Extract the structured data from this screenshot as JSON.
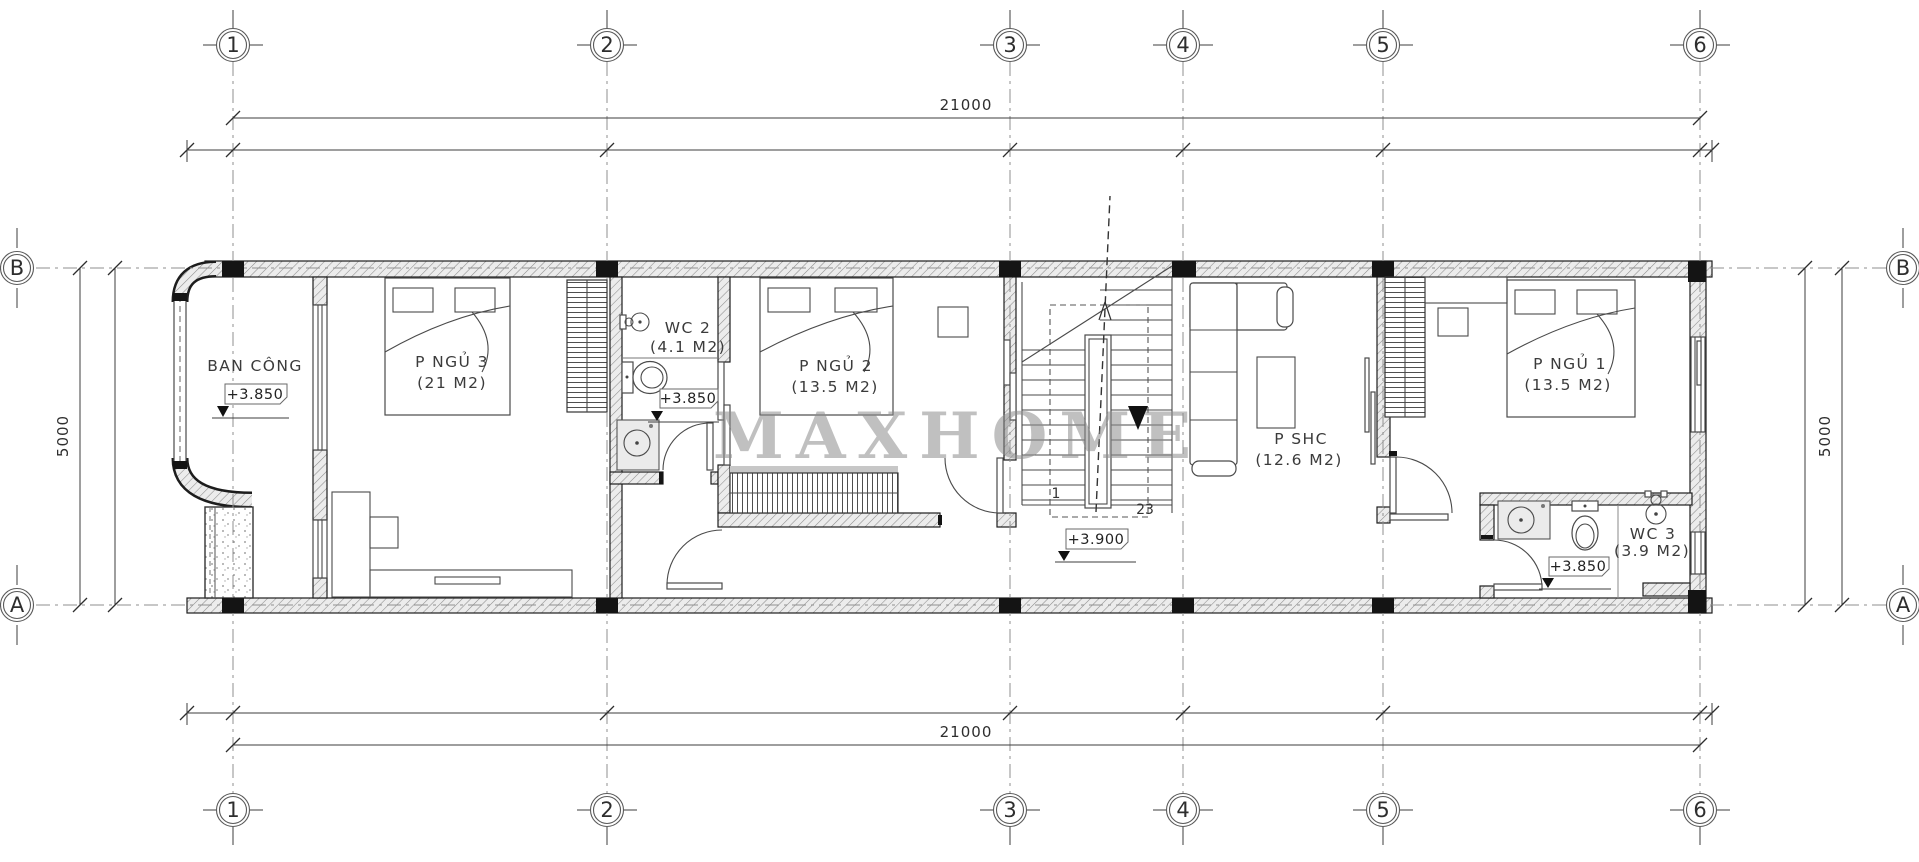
{
  "watermark": "MAXHOME",
  "grid": {
    "columns": [
      "1",
      "2",
      "3",
      "4",
      "5",
      "6"
    ],
    "rows": [
      "B",
      "A"
    ]
  },
  "dims": {
    "top": "21000",
    "bottom": "21000",
    "left": "5000",
    "right": "5000"
  },
  "labels": {
    "balcony": {
      "name": "BAN CÔNG",
      "level": "+3.850"
    },
    "bedroom3": {
      "name": "P NGỦ 3",
      "area": "(21 M2)"
    },
    "wc2": {
      "name": "WC 2",
      "area": "(4.1 M2)",
      "level": "+3.850"
    },
    "bedroom2": {
      "name": "P NGỦ 2",
      "area": "(13.5 M2)"
    },
    "stairs": {
      "level": "+3.900",
      "first": "1",
      "last": "23"
    },
    "family": {
      "name": "P SHC",
      "area": "(12.6 M2)"
    },
    "bedroom1": {
      "name": "P NGỦ 1",
      "area": "(13.5 M2)"
    },
    "wc3": {
      "name": "WC 3",
      "area": "(3.9 M2)",
      "level": "+3.850"
    }
  },
  "colors": {
    "line": "#2e2e2e",
    "hatch_bg": "#ececec",
    "watermark": "#8d8d8d"
  }
}
